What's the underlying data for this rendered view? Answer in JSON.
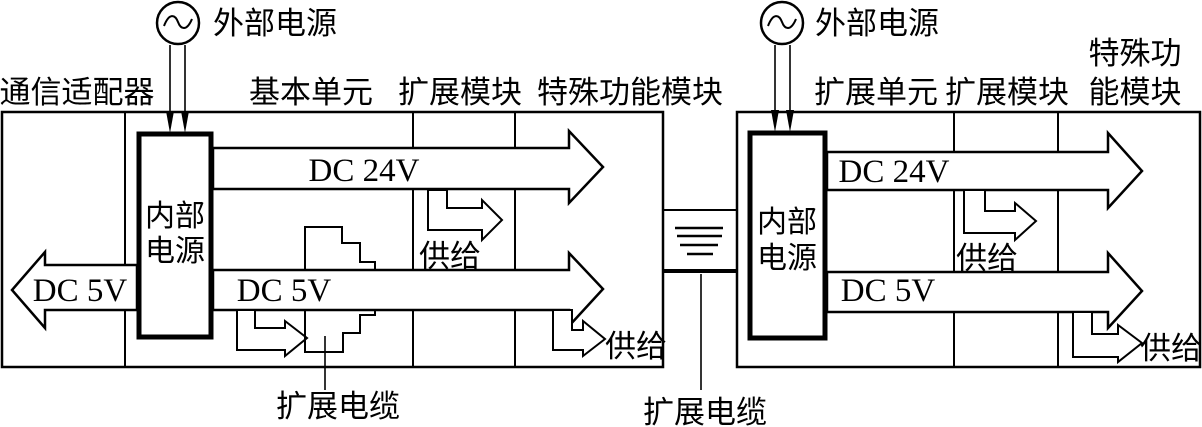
{
  "colors": {
    "line": "#000000",
    "background": "#ffffff"
  },
  "icons": {
    "ac_wave": "~"
  },
  "left_unit": {
    "ext_power": "外部电源",
    "headers": {
      "comm_adapter": "通信适配器",
      "basic_unit": "基本单元",
      "expansion_module": "扩展模块",
      "special_function_module": "特殊功能模块"
    },
    "internal_power": {
      "line1": "内部",
      "line2": "电源"
    },
    "dc24v": "DC 24V",
    "dc5v_out": "DC 5V",
    "dc5v_left": "DC 5V",
    "supply_upper": "供给",
    "supply_lower": "供给",
    "expansion_cable": "扩展电缆"
  },
  "inter_unit": {
    "expansion_cable": "扩展电缆"
  },
  "right_unit": {
    "ext_power": "外部电源",
    "headers": {
      "expansion_unit": "扩展单元",
      "expansion_module": "扩展模块",
      "special_function_line1": "特殊功",
      "special_function_line2": "能模块"
    },
    "internal_power": {
      "line1": "内部",
      "line2": "电源"
    },
    "dc24v": "DC 24V",
    "dc5v": "DC 5V",
    "supply_upper": "供给",
    "supply_lower": "供给"
  }
}
